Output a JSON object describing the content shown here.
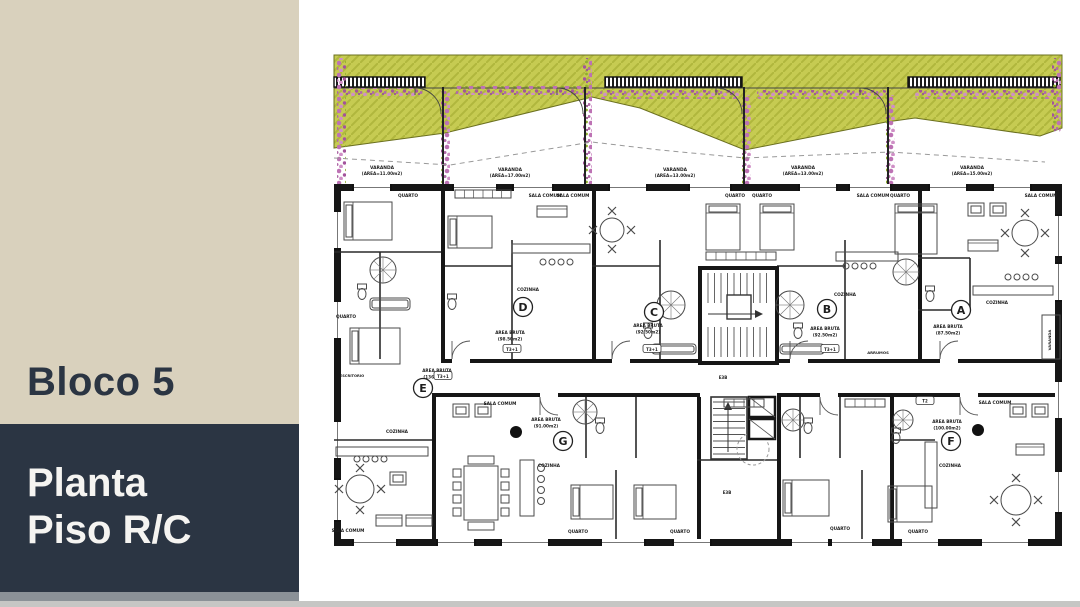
{
  "sidebar": {
    "block_title": "Bloco 5",
    "floor_title_line1": "Planta",
    "floor_title_line2": "Piso R/C"
  },
  "plan": {
    "balconies": [
      {
        "name": "VARANDA",
        "area": "(AREA=11.00m2)"
      },
      {
        "name": "VARANDA",
        "area": "(AREA=17.00m2)"
      },
      {
        "name": "VARANDA",
        "area": "(AREA=13.00m2)"
      },
      {
        "name": "VARANDA",
        "area": "(AREA=13.00m2)"
      },
      {
        "name": "VARANDA",
        "area": "(AREA=15.00m2)"
      }
    ],
    "units": [
      {
        "letter": "A",
        "area_label": "AREA BRUTA",
        "area_value": "(87.50m2)"
      },
      {
        "letter": "B",
        "area_label": "AREA BRUTA",
        "area_value": "(92.50m2)"
      },
      {
        "letter": "C",
        "area_label": "AREA BRUTA",
        "area_value": "(92.50m2)"
      },
      {
        "letter": "D",
        "area_label": "AREA BRUTA",
        "area_value": "(98.50m2)"
      },
      {
        "letter": "E",
        "area_label": "AREA BRUTA",
        "area_value": "(136.50m2)"
      },
      {
        "letter": "F",
        "area_label": "AREA BRUTA",
        "area_value": "(100.00m2)"
      },
      {
        "letter": "G",
        "area_label": "AREA BRUTA",
        "area_value": "(91.00m2)"
      }
    ],
    "rooms": {
      "quarto": "QUARTO",
      "sala_comum": "SALA COMUM",
      "cozinha": "COZINHA",
      "arrumos": "ARRUMOS",
      "escritorio": "ESCRITORIO",
      "varanda": "VARANDA",
      "tipologia": "T3+1",
      "tipologia_small": "T2",
      "core_code": "E3B"
    },
    "colors": {
      "sidebar_beige": "#d9d1bd",
      "sidebar_navy": "#2b3543",
      "garden_green": "#c6cb52",
      "garden_hatch": "#b0b73d",
      "flower_pink": "#bd72b4",
      "wall_black": "#161616"
    }
  }
}
